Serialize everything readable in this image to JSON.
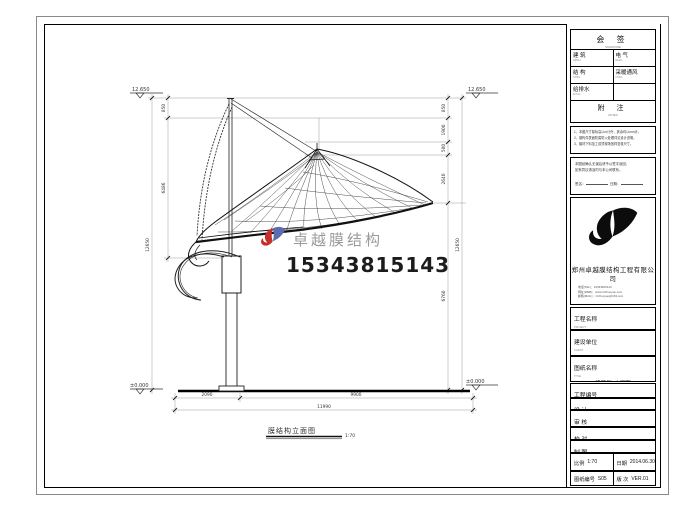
{
  "watermark": {
    "brand": "卓越膜结构",
    "phone": "15343815143"
  },
  "drawing": {
    "caption": "膜结构立面图",
    "caption_scale": "1:70",
    "elev_top_left": "12.650",
    "elev_top_right": "12.650",
    "elev_bottom_left": "±0.000",
    "elev_bottom_right": "±0.000",
    "dim_left_total": "12650",
    "dim_left_1": "850",
    "dim_left_2": "6486",
    "dim_right_total": "12650",
    "dim_right_1": "850",
    "dim_right_2": "1900",
    "dim_right_3": "500",
    "dim_right_4": "2640",
    "dim_right_5": "6760",
    "dim_bottom_1": "2090",
    "dim_bottom_2": "9900",
    "dim_bottom_total": "11990"
  },
  "titleblock": {
    "sign": {
      "title": "会 签",
      "sub": "SIGNATURE",
      "rows": [
        {
          "l": "建 筑",
          "lsub": "ARCH.",
          "r": "电 气",
          "rsub": "ELEC."
        },
        {
          "l": "结 构",
          "lsub": "STRU.",
          "r": "采暖通风",
          "rsub": "HVAC"
        },
        {
          "l": "给排水",
          "lsub": "W.S.D.",
          "r": "",
          "rsub": ""
        }
      ]
    },
    "notes": {
      "title": "附 注",
      "sub": "NOTES",
      "lines": [
        "1、本图尺寸除标高以m计外，其余均以mm计。",
        "2、钢构件表面防腐防火处理详见设计说明。",
        "3、膜材下料加工前须现场放样复核尺寸。"
      ]
    },
    "approval": {
      "lines": [
        "本图经确认无误后请予以签字返回，",
        "如有异议请及时与本公司联系。"
      ],
      "sign_label": "签名：",
      "date_label": "日期："
    },
    "company": {
      "name": "郑州卓越膜结构工程有限公司",
      "contacts": [
        "电话(TEL)：15343815143",
        "网址(WEB)：www.zzzhuoyue.com",
        "邮箱(MAIL)：zzzhuoyue@163.com"
      ]
    },
    "project": {
      "label": "工程名称",
      "sub": "PROJECT",
      "value": "客运站长途区膜结构站台"
    },
    "client": {
      "label": "建设单位",
      "sub": "CLIENT",
      "value": ""
    },
    "title": {
      "label": "图纸名称",
      "sub": "TITLE",
      "value": "建筑侧2立面图"
    },
    "pno": {
      "label": "工程编号",
      "sub": "PROJECT No.",
      "value": ""
    },
    "roles": [
      {
        "label": "设 计",
        "sub": "DESIGNER"
      },
      {
        "label": "审 核",
        "sub": "CHECKER"
      },
      {
        "label": "校 对",
        "sub": "PROOFER"
      },
      {
        "label": "制 图",
        "sub": "DRAWER"
      }
    ],
    "scale": {
      "label": "比例",
      "sub": "SCALE",
      "value": "1:70"
    },
    "date": {
      "label": "日期",
      "sub": "DATE",
      "value": "2014.06.30"
    },
    "dwg": {
      "label": "图纸编号",
      "sub": "DWG No.",
      "value": "S05"
    },
    "version": {
      "label": "版 次",
      "sub": "VERSION",
      "value": "VER.01"
    }
  }
}
